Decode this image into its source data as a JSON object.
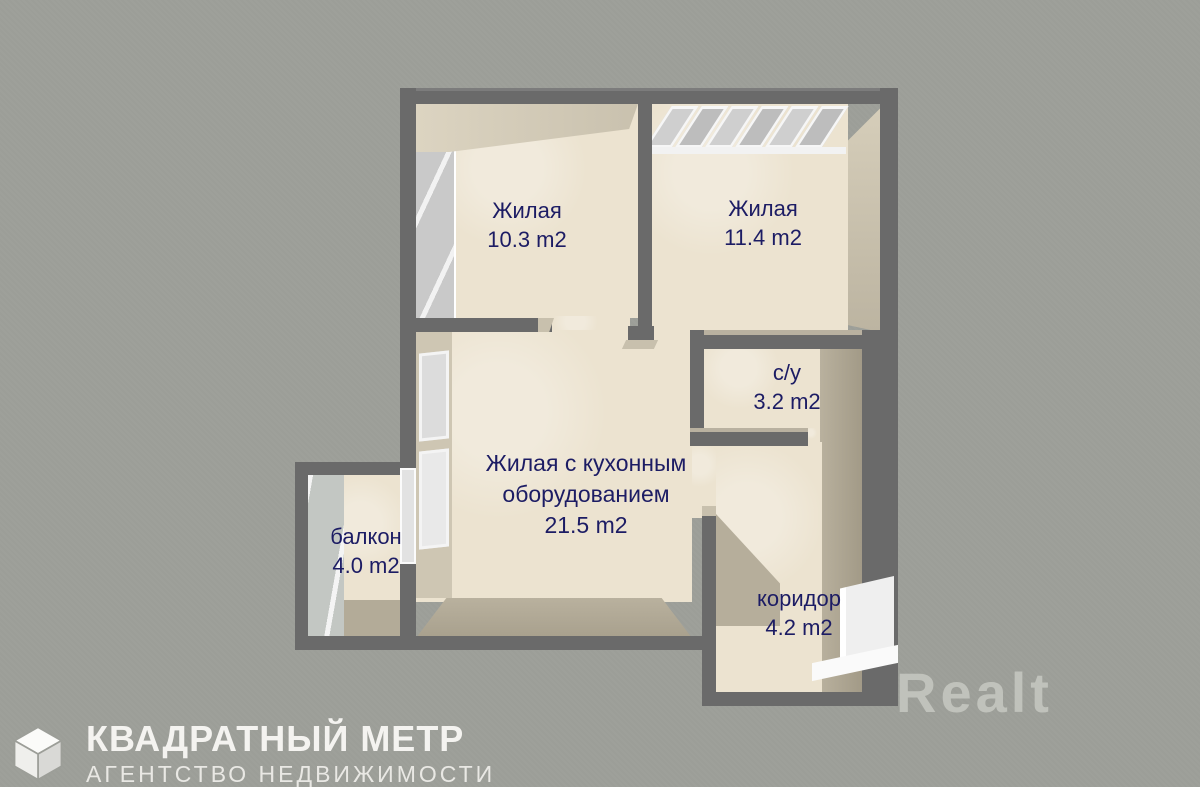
{
  "colors": {
    "background": "#9c9e98",
    "wall": "#6a6a6a",
    "floor": "#ece3d0",
    "wall_face": "#b6ae9b",
    "label_text": "#1c1c64",
    "brand_text": "#f2f2ef",
    "watermark_text": "#c7c9c2"
  },
  "rooms": {
    "living1": {
      "name": "Жилая",
      "area": "10.3 m2"
    },
    "living2": {
      "name": "Жилая",
      "area": "11.4 m2"
    },
    "bathroom": {
      "name": "с/у",
      "area": "3.2 m2"
    },
    "kitchen_living": {
      "name_line1": "Жилая с кухонным",
      "name_line2": "оборудованием",
      "area": "21.5 m2"
    },
    "balcony": {
      "name": "балкон",
      "area": "4.0 m2"
    },
    "corridor": {
      "name": "коридор",
      "area": "4.2 m2"
    }
  },
  "branding": {
    "agency_name": "КВАДРАТНЫЙ МЕТР",
    "agency_subtitle": "АГЕНТСТВО НЕДВИЖИМОСТИ",
    "logo_icon": "cube-icon",
    "watermark": "Realt"
  }
}
